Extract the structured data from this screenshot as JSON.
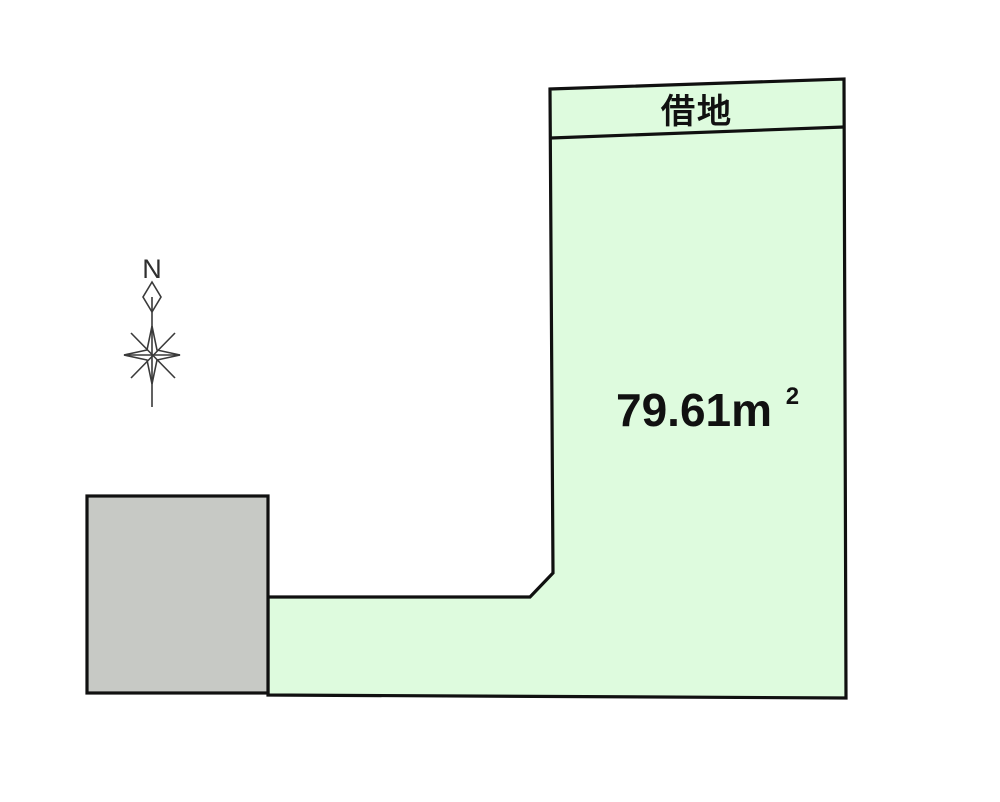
{
  "canvas": {
    "background": "#ffffff"
  },
  "parcel": {
    "band_label": "借地",
    "area_label_full": "79.61㎡",
    "area_main": "79.61m",
    "area_exponent": "2",
    "fill": "#defbde",
    "outline": "#101010"
  },
  "building": {
    "fill": "#c7c9c5",
    "outline": "#101010"
  },
  "compass": {
    "north_label": "N",
    "stroke": "#3a3a3a"
  }
}
